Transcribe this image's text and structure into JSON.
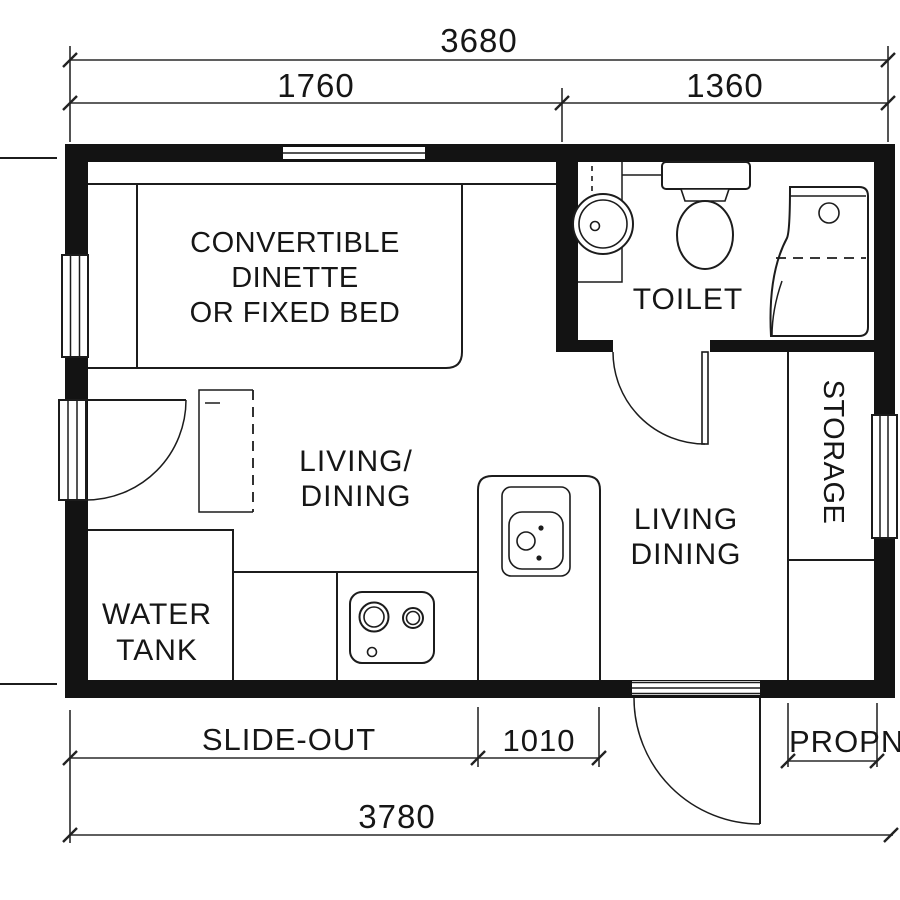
{
  "drawing_type": "tiny-house floor plan",
  "colors": {
    "ink": "#161616",
    "paper": "#ffffff"
  },
  "dimensions": {
    "top_total": "3680",
    "top_left_section": "1760",
    "top_right_section": "1360",
    "slide_out_label": "SLIDE-OUT",
    "bottom_mid_section": "1010",
    "bottom_total": "3780",
    "propane_label": "PROPNE"
  },
  "rooms": {
    "dinette": {
      "line1": "CONVERTIBLE",
      "line2": "DINETTE",
      "line3": "OR FIXED BED"
    },
    "toilet": {
      "label": "TOILET"
    },
    "living_dining_left": {
      "line1": "LIVING/",
      "line2": "DINING"
    },
    "living_dining_right": {
      "line1": "LIVING",
      "line2": "DINING"
    },
    "storage": {
      "label": "STORAGE"
    },
    "water_tank": {
      "line1": "WATER",
      "line2": "TANK"
    }
  }
}
